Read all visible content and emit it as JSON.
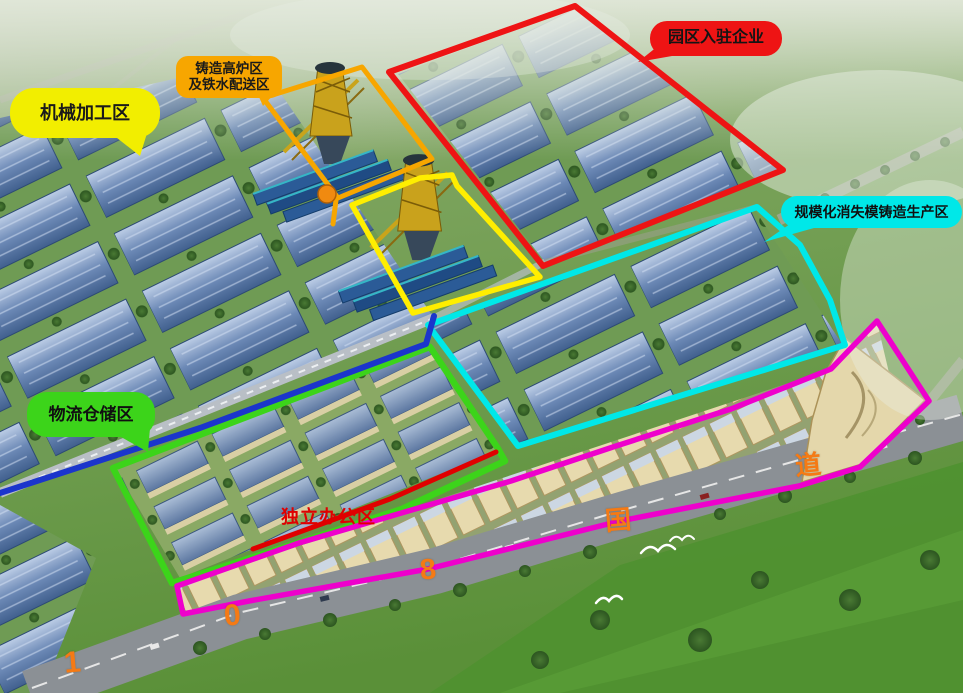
{
  "zones": {
    "enterprises": {
      "label": "园区入驻企业",
      "color": "#ee1414"
    },
    "foundry": {
      "label_line1": "铸造高炉区",
      "label_line2": "及铁水配送区",
      "color": "#f7a600"
    },
    "furnace_plot": {
      "color": "#ffee00"
    },
    "machining": {
      "label": "机械加工区",
      "color": "#f2ee00"
    },
    "lost_foam": {
      "label": "规模化消失模铸造生产区",
      "color": "#00e8e8"
    },
    "logistics": {
      "label": "物流仓储区",
      "color": "#3cd41a"
    },
    "office": {
      "label": "独立办公区",
      "color": "#e00000"
    },
    "boundary_blue": {
      "color": "#1b35cc"
    },
    "commercial": {
      "color": "#ee00cc"
    }
  },
  "road": {
    "chars": [
      "1",
      "0",
      "8",
      "国",
      "道"
    ],
    "color": "#f57a14"
  }
}
